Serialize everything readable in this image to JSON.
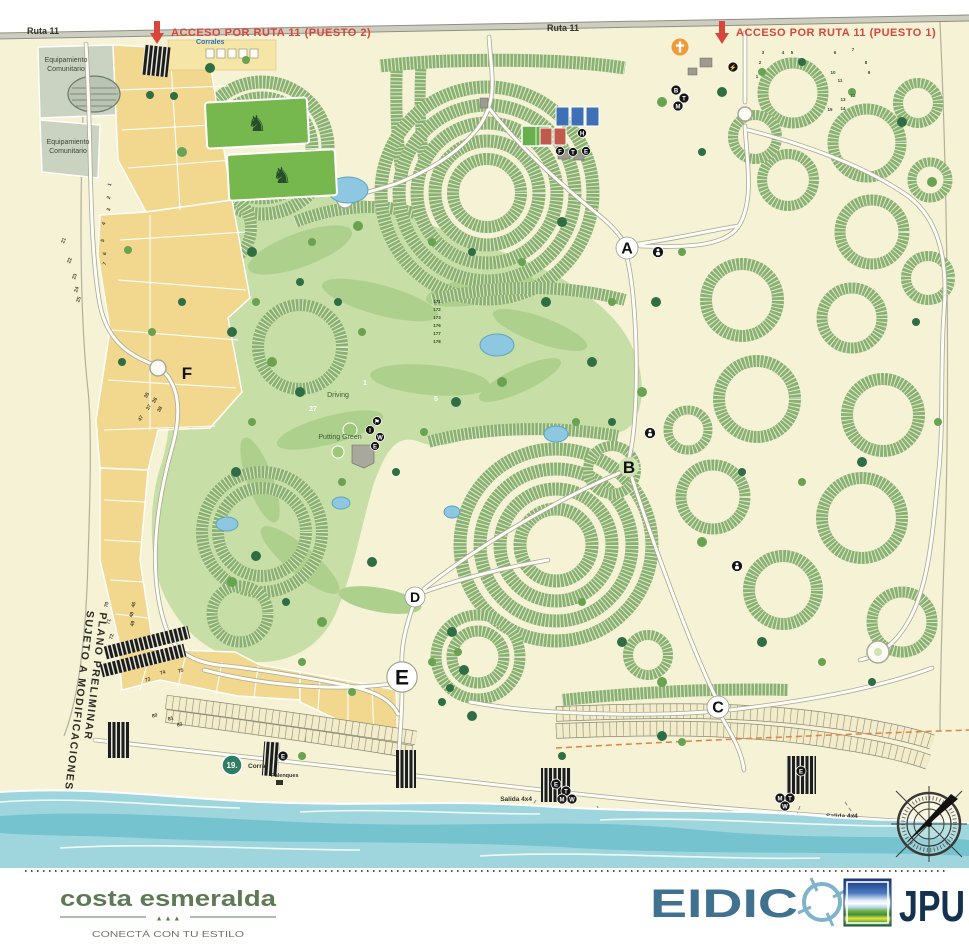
{
  "colors": {
    "background_cream": "#f6f2d6",
    "sea_teal": "#6cc0cd",
    "golf_green": "#c7dfa6",
    "lot_row_green": "#8ab16d",
    "parcel_yellow": "#f2d88e",
    "parcel_gray": "#cad3c2",
    "road_white": "#fdfdf5",
    "access_red": "#d9453a",
    "corrales_blue": "#2f6fc0",
    "boundary_dash_orange": "#e2823f",
    "brand_green": "#5d7a54",
    "eidico_blue": "#40718f",
    "eidico_crosshair_blue": "#7fb2cb",
    "jpu_navy": "#14324e",
    "corral_badge_teal": "#2e7d64",
    "church_orange": "#f09a3a"
  },
  "map": {
    "roads": {
      "ruta11_left": "Ruta 11",
      "ruta11_center": "Ruta 11"
    },
    "access_points": [
      {
        "label": "ACCESO POR RUTA 11 (PUESTO 2)"
      },
      {
        "label": "ACCESO POR RUTA 11 (PUESTO 1)"
      }
    ],
    "community_parcel": {
      "line1": "Equipamiento",
      "line2": "Comunitario"
    },
    "corrales_label": "Corrales",
    "disclaimer": {
      "line1": "PLANO PRELIMINAR",
      "line2": "SUJETO A MODIFICACIONES"
    },
    "golf": {
      "driving": "Driving",
      "putting_green": "Putting Green",
      "hole_numbers": [
        "1",
        "5",
        "27"
      ]
    },
    "sector_markers": [
      "A",
      "B",
      "C",
      "D",
      "E",
      "F"
    ],
    "beach": {
      "corral_badge": "19.",
      "corral_label": "Corral",
      "palenques_label": "Palenques",
      "salida_left": "Salida 4x4",
      "salida_right": "Salida 4x4"
    },
    "lot_numbers": {
      "left_upper": [
        "1",
        "2",
        "3",
        "4",
        "5",
        "6",
        "7"
      ],
      "left_outer": [
        "21",
        "22",
        "23",
        "24",
        "25"
      ],
      "left_mid": [
        "35",
        "36",
        "37",
        "38",
        "47"
      ],
      "left_lower": [
        "46",
        "48",
        "49",
        "70",
        "71",
        "72"
      ],
      "beachfront": [
        "73",
        "74",
        "75",
        "80",
        "81",
        "83"
      ],
      "puesto1_sector": [
        "1",
        "2",
        "3",
        "4",
        "5",
        "6",
        "7",
        "8",
        "9",
        "10",
        "11",
        "12",
        "13",
        "14",
        "15"
      ],
      "center_column": [
        "171",
        "172",
        "173",
        "176",
        "177",
        "178"
      ]
    },
    "amenity_icons": {
      "clubhouse": [
        "⚑",
        "I",
        "W",
        "E"
      ],
      "sports": [
        "H",
        "F",
        "T",
        "E"
      ],
      "entrance1": [
        "⚡",
        "B",
        "T",
        "M"
      ],
      "beach_left": [
        "E",
        "T",
        "M",
        "W",
        "X"
      ],
      "beach_right": [
        "E",
        "M",
        "T",
        "W",
        "X"
      ],
      "corral_icon": "E"
    }
  },
  "footer": {
    "brand": "costa esmeralda",
    "brand_trees": "▲ ▲ ▲",
    "tagline": "CONECTÁ CON TU ESTILO",
    "eidico_letters": "EIDIC",
    "jpu": "JPU"
  }
}
